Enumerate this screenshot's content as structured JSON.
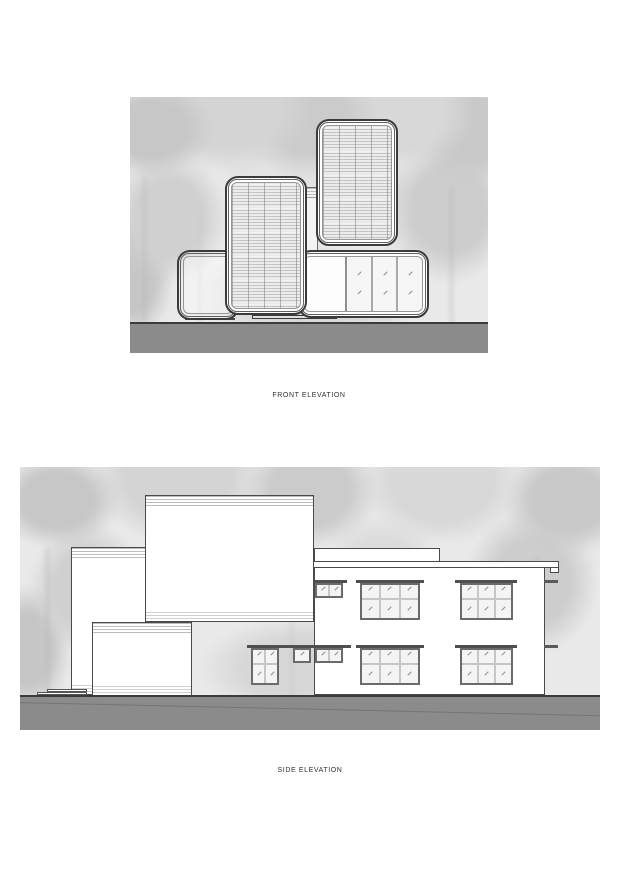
{
  "document": {
    "type": "architectural elevation sheet",
    "background": "#ffffff"
  },
  "colors": {
    "ground": "#8b8b8b",
    "outline": "#3b3b3b",
    "tree_base": "#e9e9e9",
    "window_frame": "#6b6b6b",
    "pane_fill": "#f4f4f4"
  },
  "front_elevation": {
    "caption": "FRONT ELEVATION",
    "modules": [
      {
        "name": "left-low-module",
        "finish": "glazed-frame"
      },
      {
        "name": "center-tall-module",
        "finish": "louvered"
      },
      {
        "name": "right-tall-module",
        "finish": "louvered"
      },
      {
        "name": "bottom-right-module",
        "finish": "glazed",
        "panes": 3
      },
      {
        "name": "connector-panel",
        "finish": "plain"
      }
    ]
  },
  "side_elevation": {
    "caption": "SIDE ELEVATION",
    "windows": [
      {
        "name": "upper-small",
        "cols": 2,
        "rows": 1,
        "header": {
          "left": 290,
          "top": 113,
          "width": 37,
          "height": 3
        },
        "body": {
          "left": 295,
          "top": 116,
          "width": 28,
          "height": 15
        }
      },
      {
        "name": "upper-middle",
        "cols": 3,
        "rows": 2,
        "header": {
          "left": 336,
          "top": 113,
          "width": 68,
          "height": 3
        },
        "body": {
          "left": 340,
          "top": 116,
          "width": 60,
          "height": 37
        }
      },
      {
        "name": "upper-right",
        "cols": 3,
        "rows": 2,
        "header": {
          "left": 435,
          "top": 113,
          "width": 62,
          "height": 3
        },
        "body": {
          "left": 440,
          "top": 116,
          "width": 53,
          "height": 37
        }
      },
      {
        "name": "lower-tall",
        "cols": 2,
        "rows": 2,
        "header": {
          "left": 227,
          "top": 178,
          "width": 104,
          "height": 3
        },
        "body": {
          "left": 231,
          "top": 181,
          "width": 28,
          "height": 37
        }
      },
      {
        "name": "lower-small-a",
        "cols": 1,
        "rows": 1,
        "header": null,
        "body": {
          "left": 273,
          "top": 181,
          "width": 18,
          "height": 15
        }
      },
      {
        "name": "lower-small-b",
        "cols": 2,
        "rows": 1,
        "header": null,
        "body": {
          "left": 295,
          "top": 181,
          "width": 28,
          "height": 15
        }
      },
      {
        "name": "lower-middle",
        "cols": 3,
        "rows": 2,
        "header": {
          "left": 336,
          "top": 178,
          "width": 68,
          "height": 3
        },
        "body": {
          "left": 340,
          "top": 181,
          "width": 60,
          "height": 37
        }
      },
      {
        "name": "lower-right",
        "cols": 3,
        "rows": 2,
        "header": {
          "left": 435,
          "top": 178,
          "width": 62,
          "height": 3
        },
        "body": {
          "left": 440,
          "top": 181,
          "width": 53,
          "height": 37
        }
      }
    ]
  }
}
